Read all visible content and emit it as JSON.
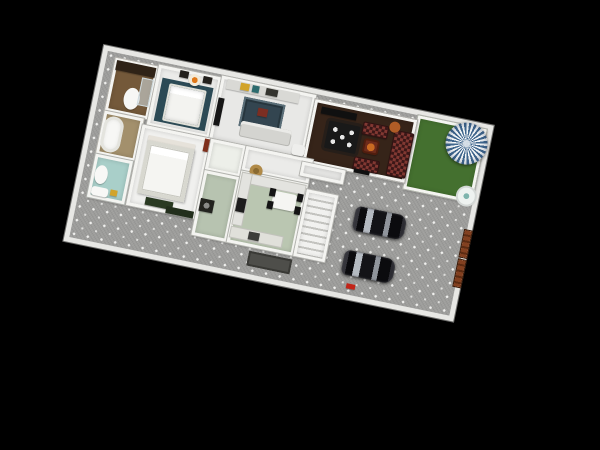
{
  "scene": {
    "type": "3d-floor-plan-render",
    "description": "Top-down 3D render of a single-storey house plot on a black background, rotated clockwise. House with two bedrooms, three baths, family room, dark lounge/dining room, kitchen, pantry and staircase; outside: lawn with striped parasol and plant pot, dotted paved driveway with two black cars, brown side gate, entry doormat.",
    "background_color": "#000000"
  },
  "palette": {
    "wall": "#e7e7e4",
    "pavement": "#9d9d9b",
    "grass": "#44702f",
    "lounge_floor": "#362419",
    "kitchen_floor": "#bac6b1",
    "teal_bath": "#a9cfc9",
    "brown_bath": "#74593a",
    "parasol_blue": "#41688f",
    "sofa_maroon": "#5e2525",
    "car_black": "#0b0b0e",
    "gate_brown": "#7c3d1d"
  },
  "plot": {
    "x": 104,
    "y": 45,
    "width": 398,
    "height": 200,
    "rotation_deg": 11.7,
    "rooms": [
      {
        "id": "lawn",
        "cls": "grass",
        "x": 322,
        "y": 5,
        "w": 70,
        "h": 75,
        "bg": "#44702f"
      },
      {
        "id": "bathroom-brown",
        "x": 14,
        "y": 10,
        "w": 44,
        "h": 54,
        "bg": "#74593a"
      },
      {
        "id": "bedroom-guest",
        "x": 58,
        "y": 8,
        "w": 64,
        "h": 62,
        "bg": "#ebebe9"
      },
      {
        "id": "family-room",
        "x": 122,
        "y": 6,
        "w": 96,
        "h": 66,
        "bg": "#e8e8e6"
      },
      {
        "id": "lounge-dining",
        "x": 218,
        "y": 10,
        "w": 104,
        "h": 64,
        "bg": "#362419"
      },
      {
        "id": "bathroom-tub",
        "x": 14,
        "y": 64,
        "w": 40,
        "h": 44,
        "bg": "#a3906c"
      },
      {
        "id": "bathroom-teal",
        "x": 14,
        "y": 108,
        "w": 38,
        "h": 44,
        "bg": "#a9cfc9"
      },
      {
        "id": "master-bedroom",
        "x": 54,
        "y": 70,
        "w": 70,
        "h": 82,
        "bg": "#f0f0ee"
      },
      {
        "id": "hallway",
        "x": 124,
        "y": 70,
        "w": 36,
        "h": 32,
        "bg": "#edefe9"
      },
      {
        "id": "entry-hall",
        "x": 160,
        "y": 70,
        "w": 68,
        "h": 25,
        "bg": "#ebebe9"
      },
      {
        "id": "pantry",
        "x": 124,
        "y": 102,
        "w": 36,
        "h": 66,
        "bg": "#b7c3b0"
      },
      {
        "id": "kitchen",
        "x": 160,
        "y": 95,
        "w": 68,
        "h": 73,
        "bg": "#bac6b1"
      },
      {
        "id": "staircase",
        "cls": "stairsroom",
        "x": 228,
        "y": 100,
        "w": 32,
        "h": 68,
        "bg": "#ededeb"
      },
      {
        "id": "porch",
        "x": 218,
        "y": 74,
        "w": 44,
        "h": 14,
        "bg": "#e5e5e3"
      }
    ],
    "objects": [
      {
        "id": "vanity-counter-brown",
        "x": 16,
        "y": 12,
        "w": 40,
        "h": 10,
        "bg": "#2f2317"
      },
      {
        "id": "toilet-brown-bath",
        "cls": "oval",
        "x": 30,
        "y": 36,
        "w": 16,
        "h": 22,
        "bg": "#f7f7f5"
      },
      {
        "id": "shower-glass",
        "cls": "glass",
        "x": 44,
        "y": 24,
        "w": 12,
        "h": 28,
        "bg": ""
      },
      {
        "id": "bed-rug-teal",
        "cls": "flat",
        "x": 64,
        "y": 20,
        "w": 52,
        "h": 44,
        "bg": "#2c4a55"
      },
      {
        "id": "bed-guest",
        "cls": "bed",
        "x": 72,
        "y": 24,
        "w": 38,
        "h": 38,
        "bg": ""
      },
      {
        "id": "tea-table-orange",
        "cls": "oval",
        "x": 90,
        "y": 10,
        "w": 12,
        "h": 12,
        "bg": "radial-gradient(circle 3px at 50% 50%,#e07818 96%,transparent) #f2ead8"
      },
      {
        "id": "chair-dark-left",
        "x": 80,
        "y": 9,
        "w": 9,
        "h": 7,
        "bg": "#23201c"
      },
      {
        "id": "chair-dark-right",
        "x": 104,
        "y": 10,
        "w": 9,
        "h": 7,
        "bg": "#23201c"
      },
      {
        "id": "wardrobe-family",
        "x": 128,
        "y": 8,
        "w": 74,
        "h": 10,
        "bg": "#d9d9d5"
      },
      {
        "id": "clothes-yellow",
        "x": 142,
        "y": 9,
        "w": 9,
        "h": 7,
        "bg": "#d2a42a"
      },
      {
        "id": "clothes-teal",
        "x": 154,
        "y": 9,
        "w": 7,
        "h": 7,
        "bg": "#2c6b6e"
      },
      {
        "id": "clothes-dark",
        "x": 168,
        "y": 9,
        "w": 12,
        "h": 7,
        "bg": "#34342f"
      },
      {
        "id": "tv-family",
        "x": 123,
        "y": 28,
        "w": 6,
        "h": 28,
        "bg": "#161616"
      },
      {
        "id": "rug-family",
        "cls": "rug flat",
        "x": 148,
        "y": 22,
        "w": 42,
        "h": 30,
        "bg": "#334550"
      },
      {
        "id": "rug-ottoman-red",
        "x": 164,
        "y": 30,
        "w": 10,
        "h": 8,
        "bg": "#7c2e22"
      },
      {
        "id": "sofa-family",
        "cls": "sofa",
        "x": 150,
        "y": 46,
        "w": 52,
        "h": 16,
        "bg": "#d4d4d0"
      },
      {
        "id": "armchair-white",
        "cls": "rounded",
        "x": 205,
        "y": 58,
        "w": 13,
        "h": 11,
        "bg": "#eeeeec"
      },
      {
        "id": "tv-console-lounge",
        "x": 226,
        "y": 16,
        "w": 36,
        "h": 7,
        "bg": "#101010"
      },
      {
        "id": "dining-table",
        "cls": "dinetable",
        "x": 236,
        "y": 28,
        "w": 32,
        "h": 28,
        "bg": ""
      },
      {
        "id": "loveseat-top",
        "cls": "checker",
        "x": 270,
        "y": 22,
        "w": 26,
        "h": 13,
        "bg": ""
      },
      {
        "id": "loveseat-bottom",
        "cls": "checker",
        "x": 268,
        "y": 58,
        "w": 26,
        "h": 13,
        "bg": ""
      },
      {
        "id": "sofa-long-maroon",
        "cls": "checker",
        "x": 302,
        "y": 24,
        "w": 20,
        "h": 46,
        "bg": ""
      },
      {
        "id": "armchair-lounge",
        "cls": "armchair",
        "x": 274,
        "y": 38,
        "w": 16,
        "h": 15,
        "bg": ""
      },
      {
        "id": "lamp-table-copper",
        "cls": "oval",
        "x": 296,
        "y": 16,
        "w": 11,
        "h": 11,
        "bg": "#b05c26"
      },
      {
        "id": "lounge-door-mark",
        "x": 270,
        "y": 70,
        "w": 16,
        "h": 4,
        "bg": "#101010"
      },
      {
        "id": "headboard-master",
        "x": 62,
        "y": 79,
        "w": 48,
        "h": 7,
        "bg": "#e6e2da"
      },
      {
        "id": "bed-master",
        "cls": "bedmaster",
        "x": 62,
        "y": 84,
        "w": 48,
        "h": 54,
        "bg": ""
      },
      {
        "id": "bench-green",
        "x": 72,
        "y": 140,
        "w": 28,
        "h": 8,
        "bg": "#2a3a22"
      },
      {
        "id": "dresser-green",
        "x": 94,
        "y": 145,
        "w": 28,
        "h": 7,
        "bg": "#222e1c"
      },
      {
        "id": "door-red-master",
        "x": 118,
        "y": 71,
        "w": 5,
        "h": 13,
        "bg": "#7e2f1c"
      },
      {
        "id": "toilet-teal-bath",
        "cls": "oval",
        "x": 17,
        "y": 118,
        "w": 13,
        "h": 19,
        "bg": "#f8f8f6"
      },
      {
        "id": "sink-teal-bath",
        "cls": "rounded",
        "x": 17,
        "y": 140,
        "w": 17,
        "h": 9,
        "bg": "#f8f8f6"
      },
      {
        "id": "towel-yellow",
        "x": 36,
        "y": 140,
        "w": 7,
        "h": 6,
        "bg": "#d2a42a"
      },
      {
        "id": "bathtub",
        "cls": "tub",
        "x": 16,
        "y": 68,
        "w": 20,
        "h": 36,
        "bg": "#f7f7f5"
      },
      {
        "id": "laundry-basket",
        "cls": "oval",
        "x": 168,
        "y": 86,
        "w": 13,
        "h": 13,
        "bg": "radial-gradient(circle 3px at 50% 50%,#8a6a30 96%,transparent) #b08a48"
      },
      {
        "id": "kitchen-counter-top",
        "cls": "counter flat",
        "x": 162,
        "y": 97,
        "w": 64,
        "h": 9,
        "bg": ""
      },
      {
        "id": "kitchen-counter-left",
        "cls": "counter flat",
        "x": 162,
        "y": 97,
        "w": 9,
        "h": 52,
        "bg": ""
      },
      {
        "id": "stove",
        "x": 162,
        "y": 122,
        "w": 9,
        "h": 14,
        "bg": "#1d1d1d"
      },
      {
        "id": "kitchen-counter-bottom",
        "cls": "counter flat",
        "x": 162,
        "y": 152,
        "w": 52,
        "h": 10,
        "bg": "#e0e0da"
      },
      {
        "id": "kitchen-sink",
        "x": 180,
        "y": 153,
        "w": 11,
        "h": 8,
        "bg": "#3c3c3a"
      },
      {
        "id": "kitchen-table",
        "cls": "rounded",
        "x": 196,
        "y": 108,
        "w": 24,
        "h": 17,
        "bg": "#f5f5f2"
      },
      {
        "id": "kitchen-chair-1",
        "x": 192,
        "y": 106,
        "w": 6,
        "h": 8,
        "bg": "#141414"
      },
      {
        "id": "kitchen-chair-2",
        "x": 220,
        "y": 106,
        "w": 6,
        "h": 8,
        "bg": "#141414"
      },
      {
        "id": "kitchen-chair-3",
        "x": 192,
        "y": 119,
        "w": 6,
        "h": 8,
        "bg": "#141414"
      },
      {
        "id": "kitchen-chair-4",
        "x": 220,
        "y": 119,
        "w": 6,
        "h": 8,
        "bg": "#141414"
      },
      {
        "id": "washing-machine",
        "x": 126,
        "y": 130,
        "w": 14,
        "h": 13,
        "bg": "radial-gradient(circle 3px at 50% 50%,#8a8a88 96%,transparent) #23231f"
      },
      {
        "id": "doormat",
        "cls": "mat",
        "x": 184,
        "y": 172,
        "w": 44,
        "h": 15,
        "bg": ""
      },
      {
        "id": "car-1",
        "cls": "car",
        "x": 280,
        "y": 106,
        "w": 52,
        "h": 25,
        "bg": ""
      },
      {
        "id": "car-2",
        "cls": "car",
        "x": 278,
        "y": 151,
        "w": 52,
        "h": 25,
        "bg": ""
      },
      {
        "id": "gate-panel-upper",
        "cls": "gate",
        "x": 391,
        "y": 108,
        "w": 7,
        "h": 27,
        "bg": ""
      },
      {
        "id": "gate-panel-lower",
        "cls": "gate",
        "x": 391,
        "y": 138,
        "w": 7,
        "h": 27,
        "bg": ""
      },
      {
        "id": "red-item-driveway",
        "x": 286,
        "y": 184,
        "w": 9,
        "h": 5,
        "bg": "#c22418"
      },
      {
        "id": "parasol",
        "cls": "parasol",
        "x": 354,
        "y": 2,
        "w": 42,
        "h": 42,
        "bg": ""
      },
      {
        "id": "plant-pot",
        "cls": "pot",
        "x": 377,
        "y": 66,
        "w": 17,
        "h": 17,
        "bg": ""
      }
    ]
  }
}
